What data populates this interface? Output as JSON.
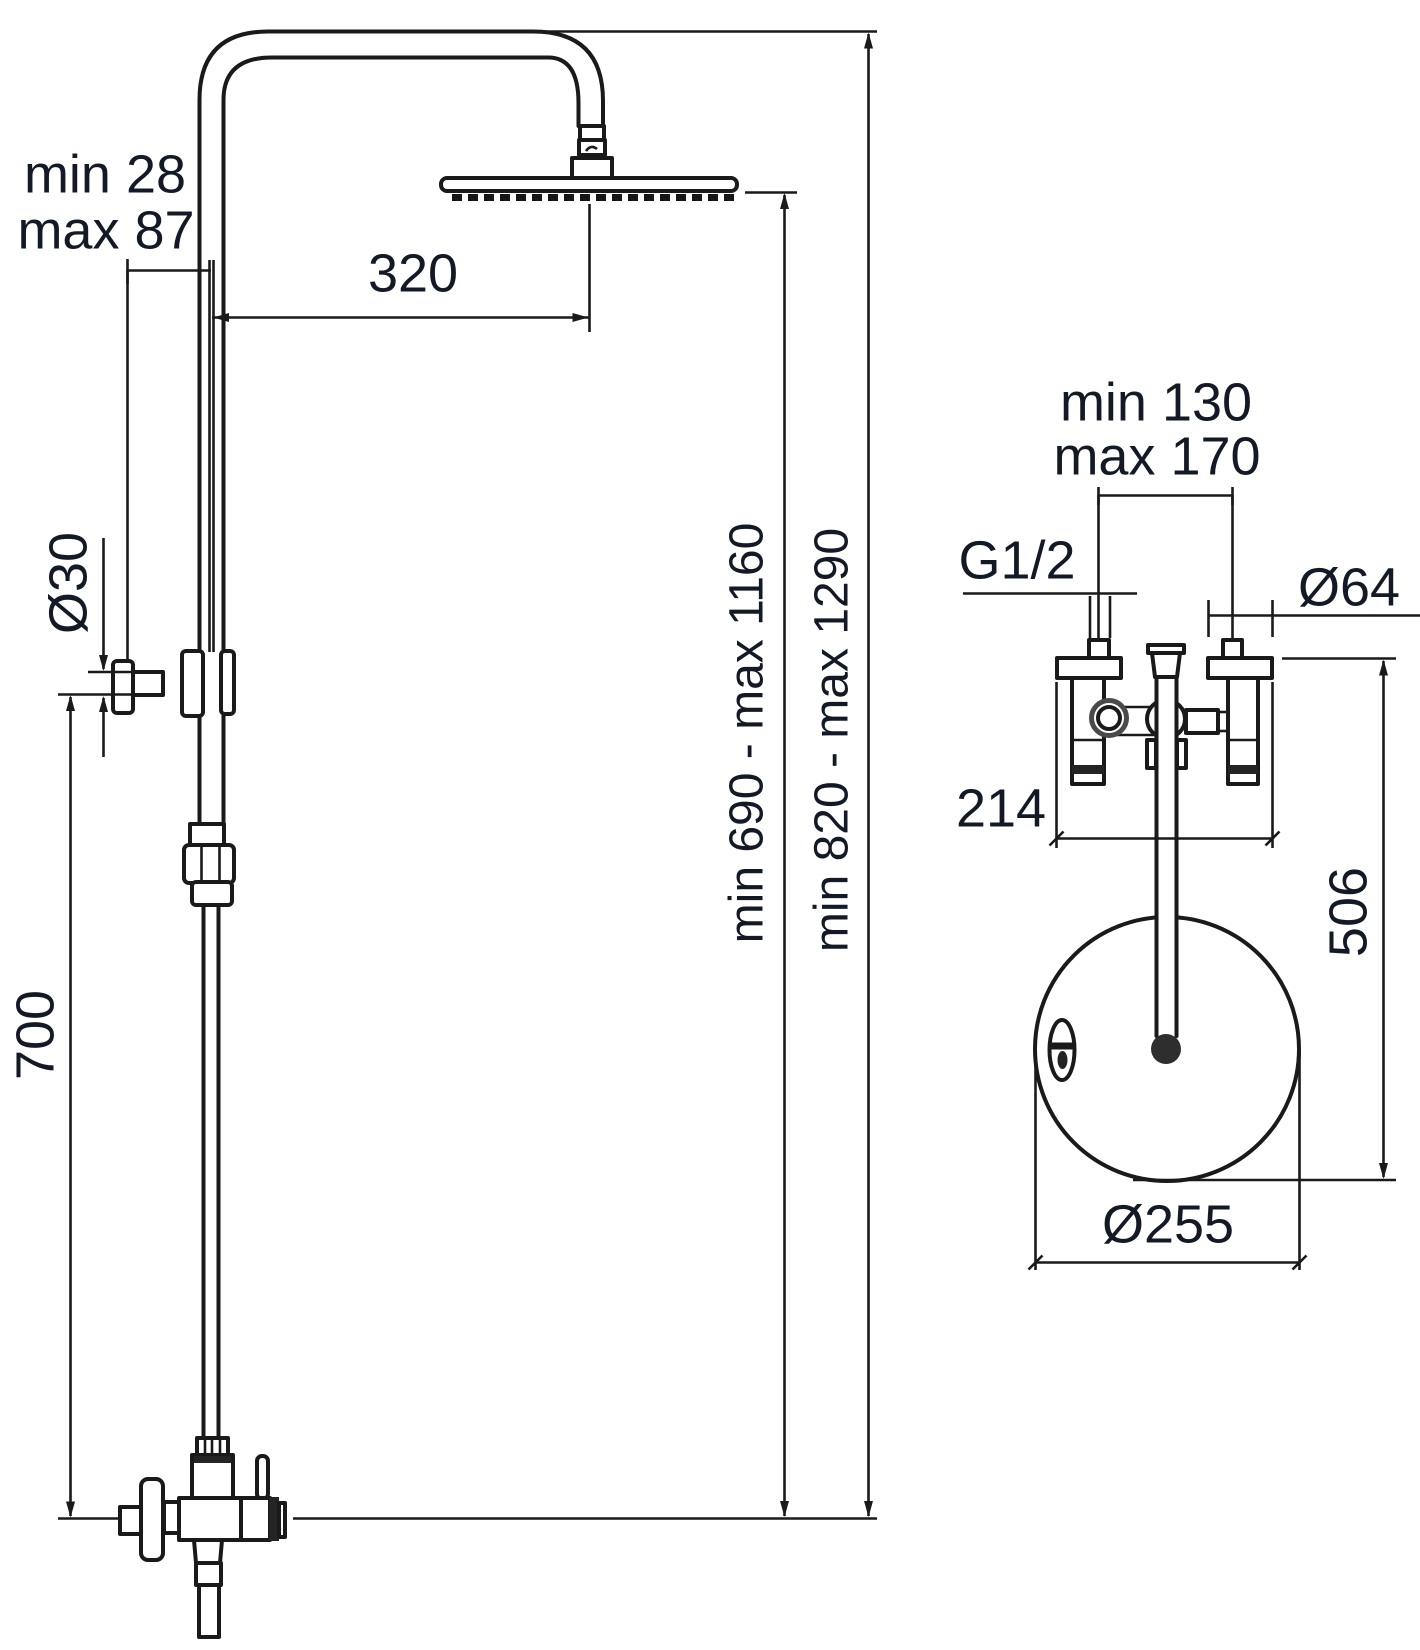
{
  "meta": {
    "title": "Shower column dimensional technical drawing",
    "views": [
      "front view with riser and mixer",
      "top view of wall unions and head plate"
    ],
    "colors": {
      "line": "#1a1a1a",
      "text": "#131a26",
      "background": "#ffffff"
    }
  },
  "front": {
    "wall_min": "min 28",
    "wall_max": "max 87",
    "reach": "320",
    "holder_dia": "Ø30",
    "holder_height": "700",
    "head_height": "min 690 - max 1160",
    "total_height": "min 820 - max 1290"
  },
  "top": {
    "spacing_min": "min 130",
    "spacing_max": "max 170",
    "thread": "G1/2",
    "union_dia": "Ø64",
    "body_width": "214",
    "depth": "506",
    "plate_dia": "Ø255"
  }
}
